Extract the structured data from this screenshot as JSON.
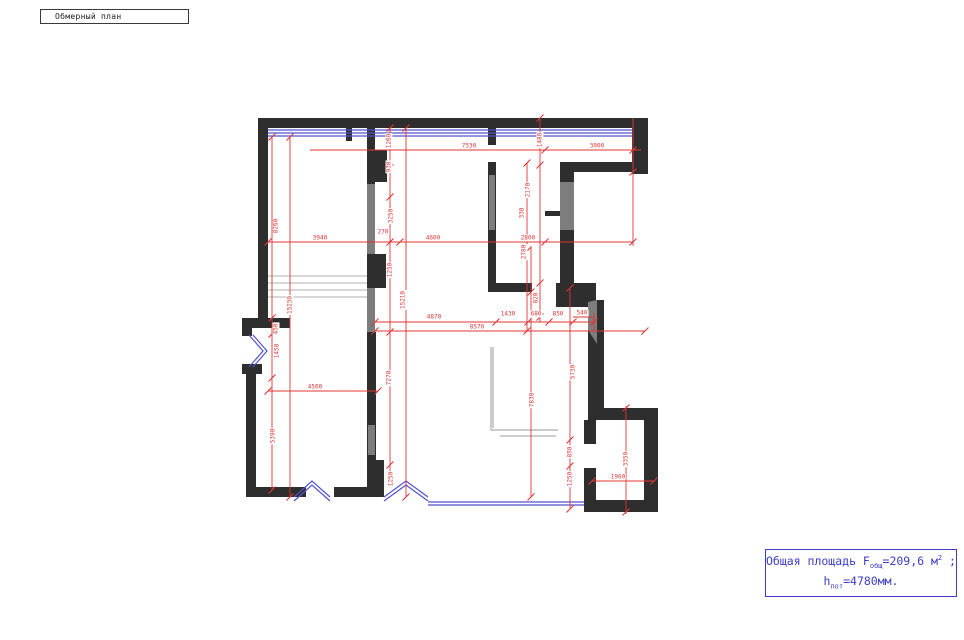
{
  "title_bar": {
    "label": "Обмерный план"
  },
  "summary": {
    "area_prefix": "Общая площадь F",
    "area_sub": "общ",
    "area_value": "=209,6 м",
    "area_sup": "2",
    "area_tail": " ;",
    "height_prefix": "h",
    "height_sub": "пот",
    "height_value": "=4780мм."
  },
  "colors": {
    "dimension_red": "#e03535",
    "wall_dark": "#2e2e2e",
    "wall_gray": "#7d7d7d",
    "window_blue": "#5252cc",
    "text_blue": "#3c3cc8"
  },
  "plan": {
    "labels": [
      {
        "t": "7530",
        "x": 469,
        "y": 146,
        "r": 0
      },
      {
        "t": "3000",
        "x": 597,
        "y": 146,
        "r": 0
      },
      {
        "t": "3940",
        "x": 320,
        "y": 238,
        "r": 0
      },
      {
        "t": "270",
        "x": 383,
        "y": 232,
        "r": 0
      },
      {
        "t": "4600",
        "x": 433,
        "y": 238,
        "r": 0
      },
      {
        "t": "2800",
        "x": 528,
        "y": 238,
        "r": 0
      },
      {
        "t": "4870",
        "x": 434,
        "y": 317,
        "r": 0
      },
      {
        "t": "1430",
        "x": 508,
        "y": 314,
        "r": 0
      },
      {
        "t": "680",
        "x": 536,
        "y": 314,
        "r": 0
      },
      {
        "t": "850",
        "x": 558,
        "y": 314,
        "r": 0
      },
      {
        "t": "540",
        "x": 582,
        "y": 313,
        "r": 0
      },
      {
        "t": "8570",
        "x": 477,
        "y": 327,
        "r": 0
      },
      {
        "t": "4500",
        "x": 315,
        "y": 387,
        "r": 0
      },
      {
        "t": "1960",
        "x": 618,
        "y": 477,
        "r": 0
      },
      {
        "t": "8260",
        "x": 276,
        "y": 226,
        "r": -90
      },
      {
        "t": "1260",
        "x": 389,
        "y": 141,
        "r": -90
      },
      {
        "t": "930",
        "x": 389,
        "y": 167,
        "r": -90
      },
      {
        "t": "3250",
        "x": 391,
        "y": 216,
        "r": -90
      },
      {
        "t": "1480",
        "x": 540,
        "y": 140,
        "r": -90
      },
      {
        "t": "2170",
        "x": 528,
        "y": 190,
        "r": -90
      },
      {
        "t": "330",
        "x": 522,
        "y": 213,
        "r": -90
      },
      {
        "t": "2780",
        "x": 524,
        "y": 252,
        "r": -90
      },
      {
        "t": "1250",
        "x": 390,
        "y": 270,
        "r": -90
      },
      {
        "t": "820",
        "x": 536,
        "y": 298,
        "r": -90
      },
      {
        "t": "15230",
        "x": 290,
        "y": 305,
        "r": -90
      },
      {
        "t": "15210",
        "x": 403,
        "y": 300,
        "r": -90
      },
      {
        "t": "450",
        "x": 276,
        "y": 329,
        "r": -90
      },
      {
        "t": "1450",
        "x": 277,
        "y": 351,
        "r": -90
      },
      {
        "t": "7270",
        "x": 389,
        "y": 378,
        "r": -90
      },
      {
        "t": "5390",
        "x": 273,
        "y": 436,
        "r": -90
      },
      {
        "t": "7830",
        "x": 532,
        "y": 400,
        "r": -90
      },
      {
        "t": "5730",
        "x": 573,
        "y": 372,
        "r": -90
      },
      {
        "t": "850",
        "x": 570,
        "y": 452,
        "r": -90
      },
      {
        "t": "1250",
        "x": 570,
        "y": 479,
        "r": -90
      },
      {
        "t": "3350",
        "x": 626,
        "y": 459,
        "r": -90
      },
      {
        "t": "1250",
        "x": 391,
        "y": 479,
        "r": -90
      }
    ]
  }
}
